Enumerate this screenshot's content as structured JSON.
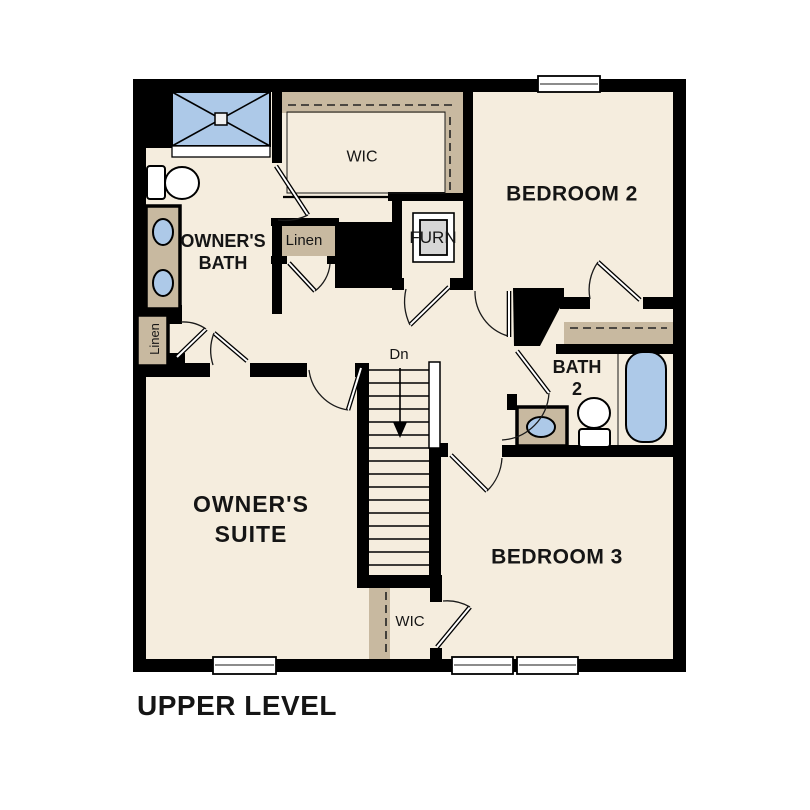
{
  "plan": {
    "title": "UPPER LEVEL"
  },
  "colors": {
    "background": "#ffffff",
    "floor": "#f5edde",
    "wall": "#000000",
    "shelf": "#c8b9a0",
    "fixture_blue": "#adc9e8",
    "furnace_gray": "#d6d6d6",
    "text": "#151515"
  },
  "rooms": {
    "wic_top": {
      "label": "WIC"
    },
    "bedroom2": {
      "label": "BEDROOM 2"
    },
    "owners_bath": {
      "line1": "OWNER'S",
      "line2": "BATH"
    },
    "linen_hall": {
      "label": "Linen"
    },
    "furnace_closet": {
      "label": "FURN"
    },
    "bath2": {
      "line1": "BATH",
      "line2": "2"
    },
    "stairs": {
      "down_label": "Dn"
    },
    "owners_suite": {
      "line1": "OWNER'S",
      "line2": "SUITE"
    },
    "bedroom3": {
      "label": "BEDROOM 3"
    },
    "wic_bottom": {
      "label": "WIC"
    },
    "linen_owners_suite": {
      "label": "Linen"
    }
  },
  "fixtures": {
    "icons": [
      "shower-icon",
      "toilet-icon",
      "double-sink-vanity-icon",
      "sink-vanity-icon",
      "bathtub-icon",
      "furnace-icon",
      "stairs-down-arrow-icon",
      "closet-rod-dashed-line",
      "window-icon",
      "door-swing-icon"
    ]
  }
}
